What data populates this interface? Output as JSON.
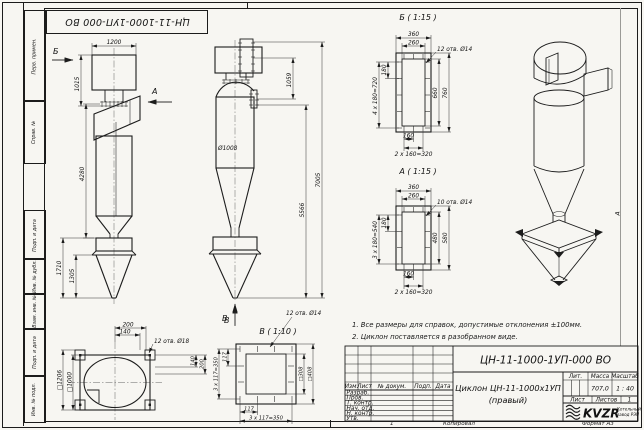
{
  "frame": {
    "left_stamps": [
      {
        "label": "Перв. примен."
      },
      {
        "label": "Справ. №"
      },
      {
        "label": "Подп. и дата"
      },
      {
        "label": "Инв. № дубл."
      },
      {
        "label": "Взам. инв. №"
      },
      {
        "label": "Подп. и дата"
      },
      {
        "label": "Инв. № подл."
      }
    ],
    "top_designation": "ЦН-11-1000-1УП-000 ВО",
    "zone_marker": "А"
  },
  "views": {
    "front": {
      "arrow_b": "Б",
      "arrow_a": "А",
      "dim_width": "1200",
      "dim_inlet": "1015",
      "dim_body": "4280",
      "dim_bunker": "1710",
      "dim_cone": "1305"
    },
    "side": {
      "dim_flange": "1059",
      "dim_dia": "Ø1008",
      "dim_body": "5566",
      "dim_total": "7005",
      "arrow_v": "В"
    },
    "section_b": {
      "title": "Б ( 1:15 )",
      "holes": "12 отв. Ø14",
      "dim_out_w": "360",
      "dim_in_w": "260",
      "dim_pitch1": "180",
      "dim_pitch_v": "4 x 180=720",
      "dim_in_h": "660",
      "dim_out_h": "760",
      "dim_pitch_b1": "160",
      "dim_pitch_b": "2 x 160=320"
    },
    "section_a": {
      "title": "А ( 1:15 )",
      "holes": "10 отв. Ø14",
      "dim_out_w": "360",
      "dim_in_w": "260",
      "dim_pitch1": "180",
      "dim_pitch_v": "3 x 180=540",
      "dim_in_h": "480",
      "dim_out_h": "580",
      "dim_pitch_b1": "160",
      "dim_pitch_b": "2 x 160=320"
    },
    "plan": {
      "holes": "12 отв. Ø18",
      "dim_1": "200",
      "dim_2": "140",
      "dim_sq_out": "□1206",
      "dim_sq_in": "□1000",
      "dim_3": "140",
      "dim_4": "200"
    },
    "section_v": {
      "title": "В ( 1:10 )",
      "holes": "12 отв. Ø14",
      "dim_pitch1": "117",
      "dim_pitch_l": "3 x 117=350",
      "dim_pitch_b1": "117",
      "dim_pitch_b": "3 x 117=350",
      "dim_sq_in": "□308",
      "dim_sq_out": "□408"
    }
  },
  "notes": {
    "line1": "1. Все размеры для справок, допустимые отклонения ±100мм.",
    "line2": "2. Циклон поставляется в разобранном виде."
  },
  "title_block": {
    "designation": "ЦН-11-1000-1УП-000 ВО",
    "name": "Циклон ЦН-11-1000х1УП",
    "name2": "(правый)",
    "col_izm": "Изм.",
    "col_list": "Лист",
    "col_doc": "№ докум.",
    "col_podp": "Подп.",
    "col_data": "Дата",
    "roles": [
      "Разраб.",
      "Пров.",
      "Т. контр.",
      "Нач. отд.",
      "Н. контр.",
      "Утв."
    ],
    "lit": "Лит.",
    "mass_label": "Масса",
    "scale_label": "Масштаб",
    "mass": "707,0",
    "scale": "1 : 40",
    "sheet_label": "Лист",
    "sheets_label": "Листов",
    "sheets_value": "1",
    "logo_text": "KVZR",
    "company1": "Котельный",
    "company2": "завод РЭП",
    "copied": "Копировал",
    "format": "Формат А3",
    "zone": "1"
  }
}
